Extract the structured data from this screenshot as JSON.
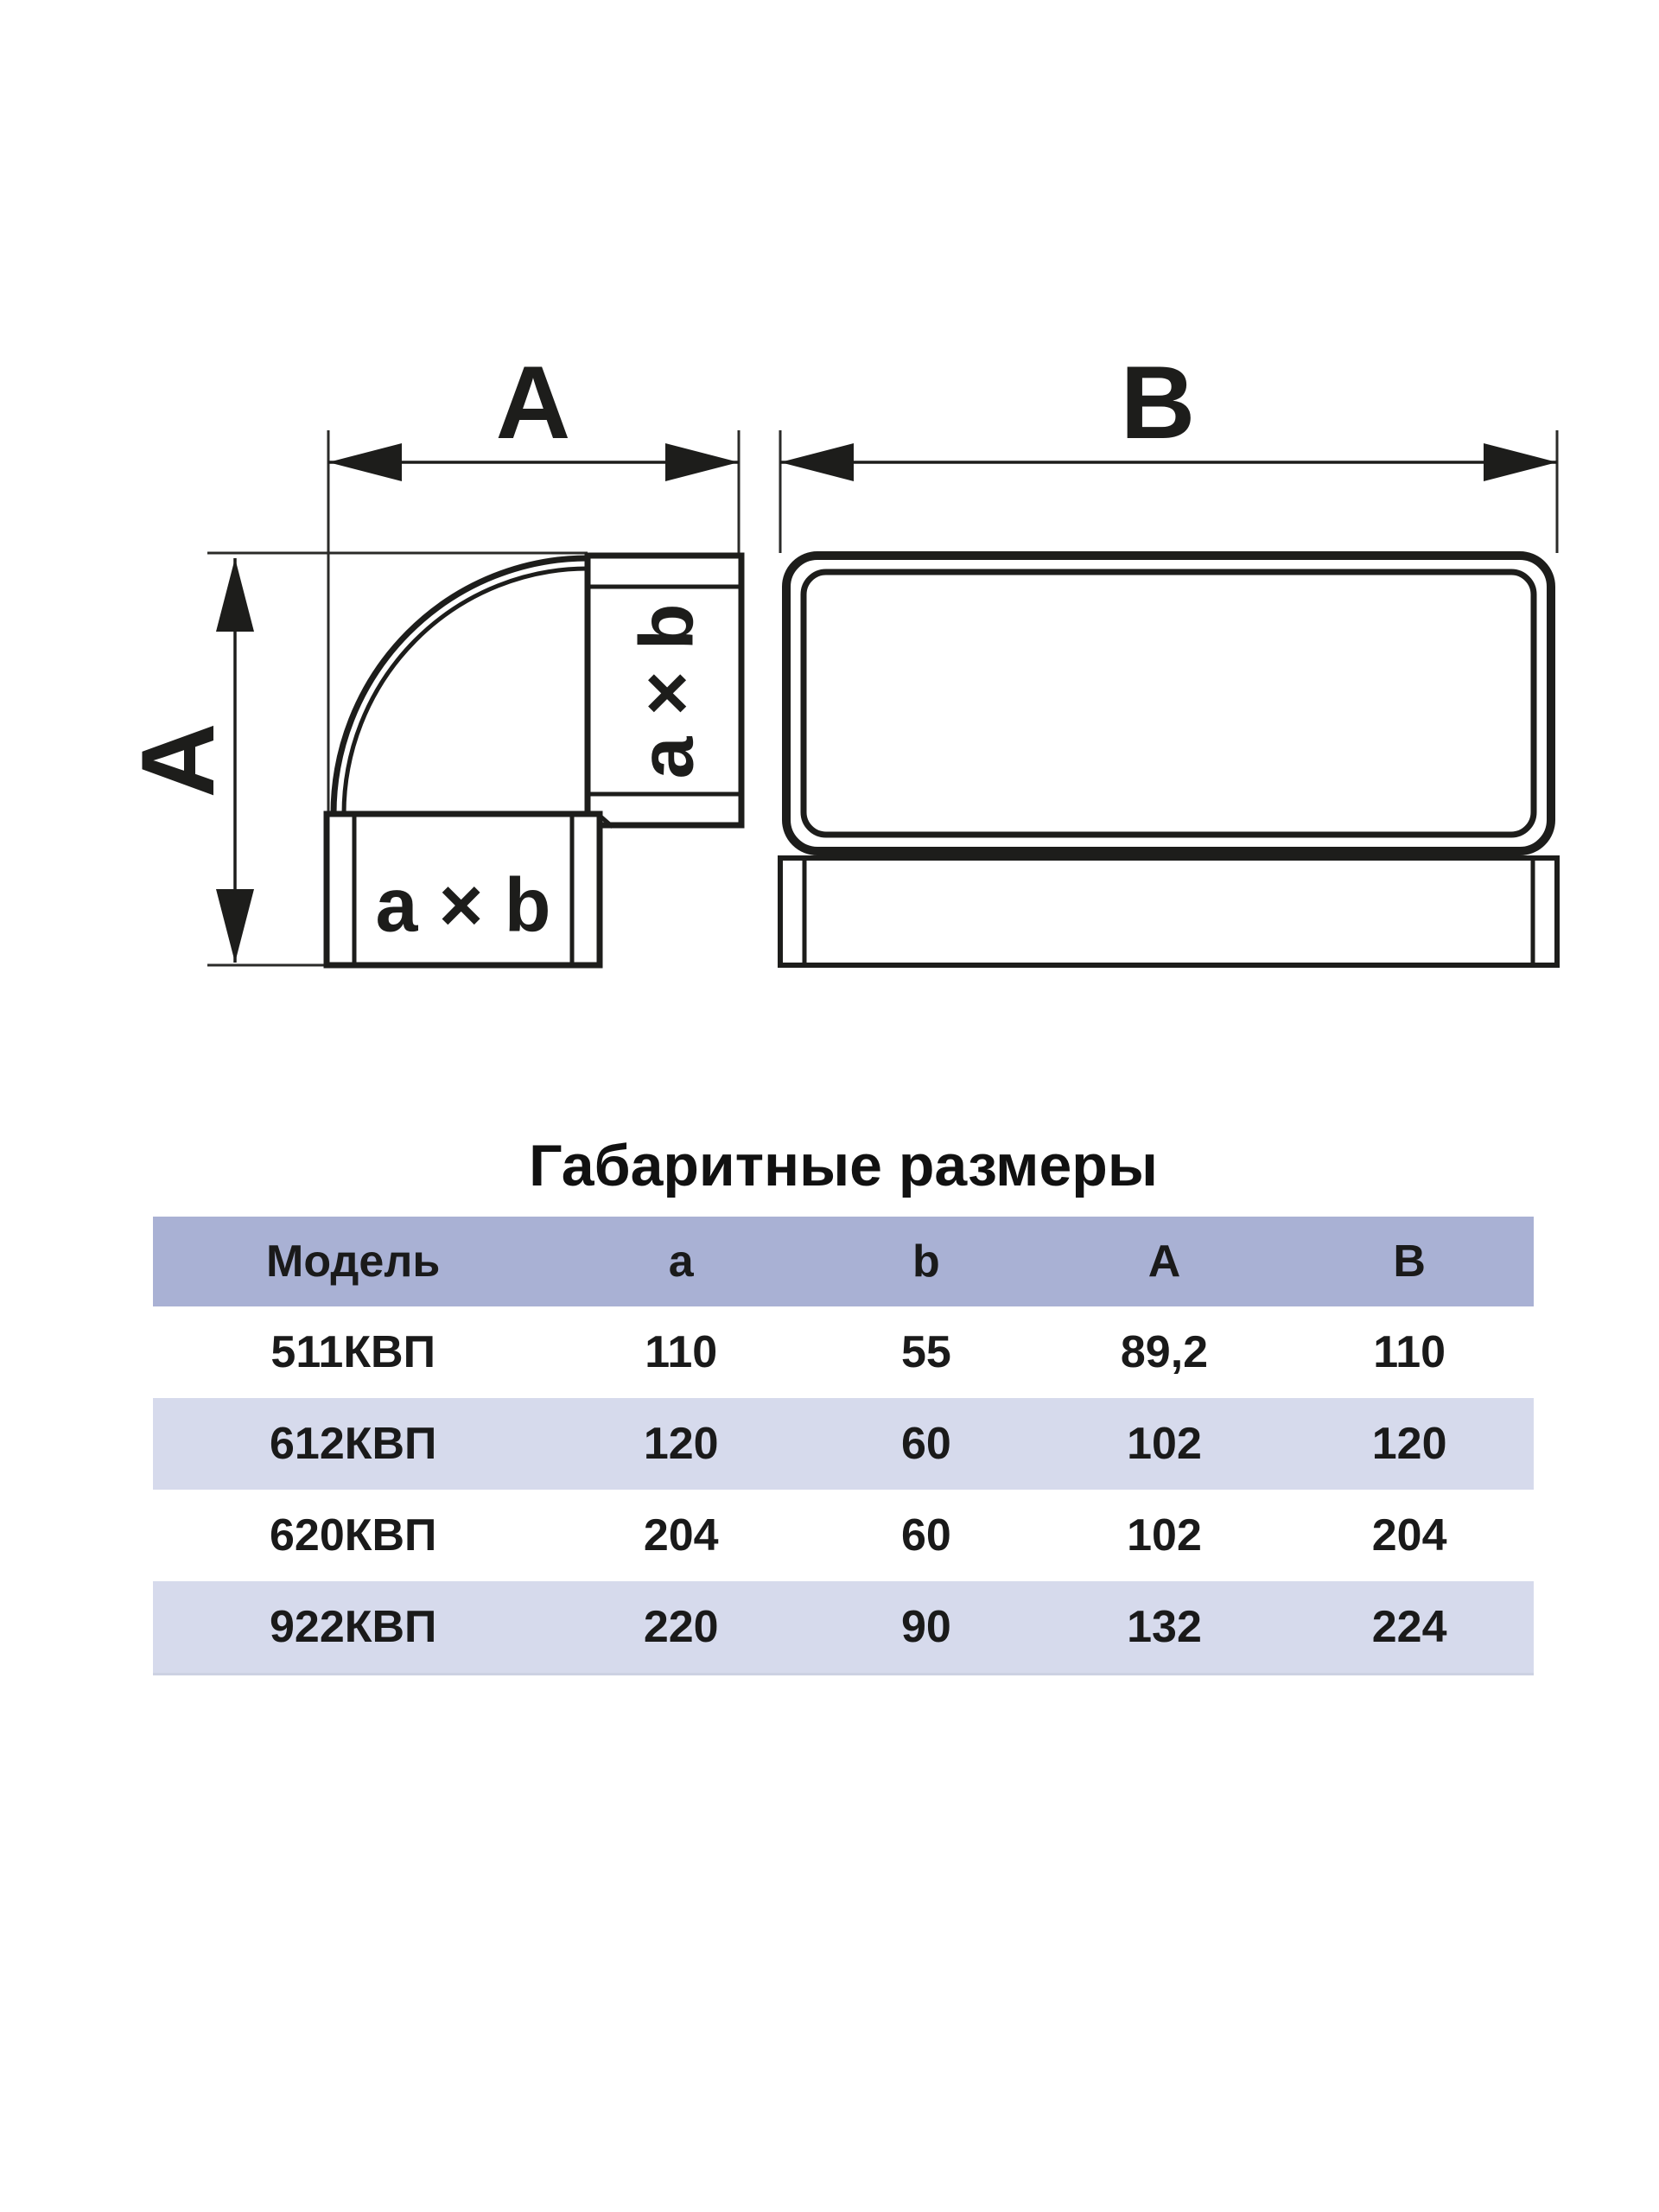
{
  "diagrams": {
    "elbow": {
      "dim_horizontal_label": "A",
      "dim_vertical_label": "A",
      "port_bottom_label": "a × b",
      "port_side_label": "a × b"
    },
    "duct": {
      "dim_label": "B"
    }
  },
  "section": {
    "title": "Габаритные размеры"
  },
  "table": {
    "columns": [
      "Модель",
      "a",
      "b",
      "A",
      "B"
    ],
    "rows": [
      {
        "model": "511КВП",
        "a": "110",
        "b": "55",
        "A": "89,2",
        "B": "110"
      },
      {
        "model": "612КВП",
        "a": "120",
        "b": "60",
        "A": "102",
        "B": "120"
      },
      {
        "model": "620КВП",
        "a": "204",
        "b": "60",
        "A": "102",
        "B": "204"
      },
      {
        "model": "922КВП",
        "a": "220",
        "b": "90",
        "A": "132",
        "B": "224"
      }
    ],
    "colors": {
      "header_bg": "#a9b1d4",
      "row_alt_bg": "#d6daec",
      "row_bg": "#ffffff",
      "line_color": "#1d1d1b",
      "text": "#1a1a1a"
    }
  }
}
